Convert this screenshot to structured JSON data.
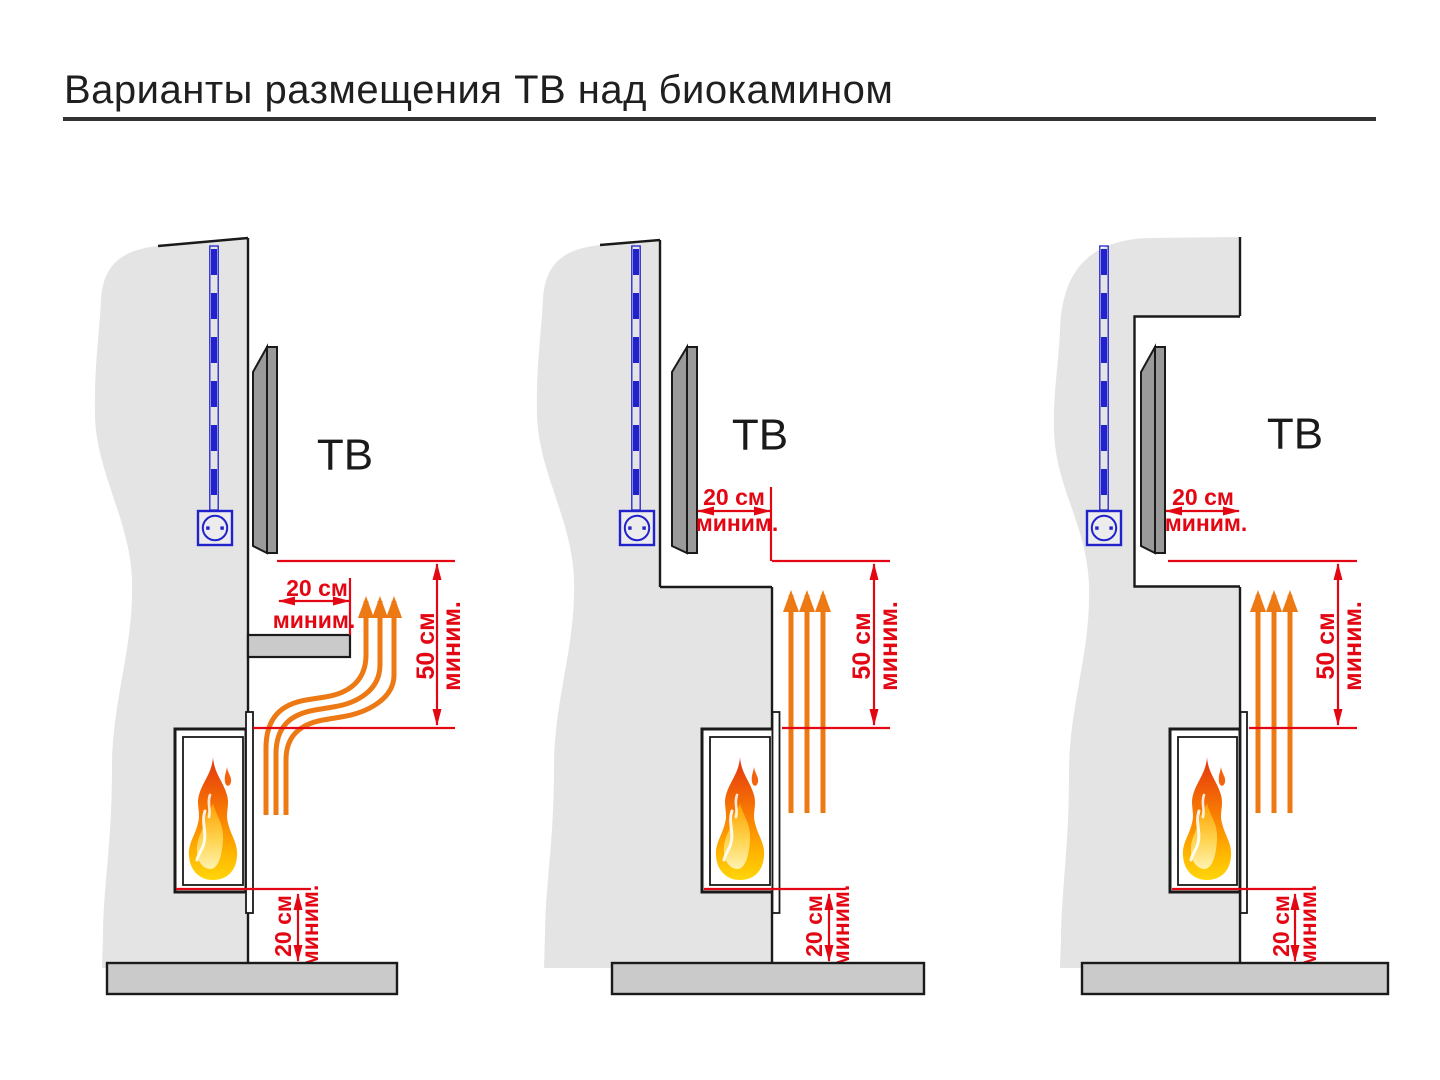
{
  "title": "Варианты размещения ТВ над биокамином",
  "colors": {
    "dimension_red": "#e30613",
    "heat_orange": "#ed7914",
    "cable_blue": "#2222cc",
    "wall_gray": "#e4e4e4",
    "floor_gray": "#cacaca",
    "tv_gray": "#9a9a9a",
    "title_black": "#1f1f1f"
  },
  "icons": {
    "flame": "flame-icon",
    "power_outlet": "power-outlet-icon",
    "power_cable": "power-cable-icon",
    "heat_flow": "heat-arrows-icon"
  },
  "variants": [
    {
      "tv_label": "ТВ",
      "tv_gap": {
        "value": "20 см",
        "qualifier": "миним."
      },
      "fire_gap": {
        "value": "50 см",
        "qualifier": "миним."
      },
      "floor_gap": {
        "value": "20 см",
        "qualifier": "миним."
      }
    },
    {
      "tv_label": "ТВ",
      "tv_gap": {
        "value": "20 см",
        "qualifier": "миним."
      },
      "fire_gap": {
        "value": "50 см",
        "qualifier": "миним."
      },
      "floor_gap": {
        "value": "20 см",
        "qualifier": "миним."
      }
    },
    {
      "tv_label": "ТВ",
      "tv_gap": {
        "value": "20 см",
        "qualifier": "миним."
      },
      "fire_gap": {
        "value": "50 см",
        "qualifier": "миним."
      },
      "floor_gap": {
        "value": "20 см",
        "qualifier": "миним."
      }
    }
  ]
}
